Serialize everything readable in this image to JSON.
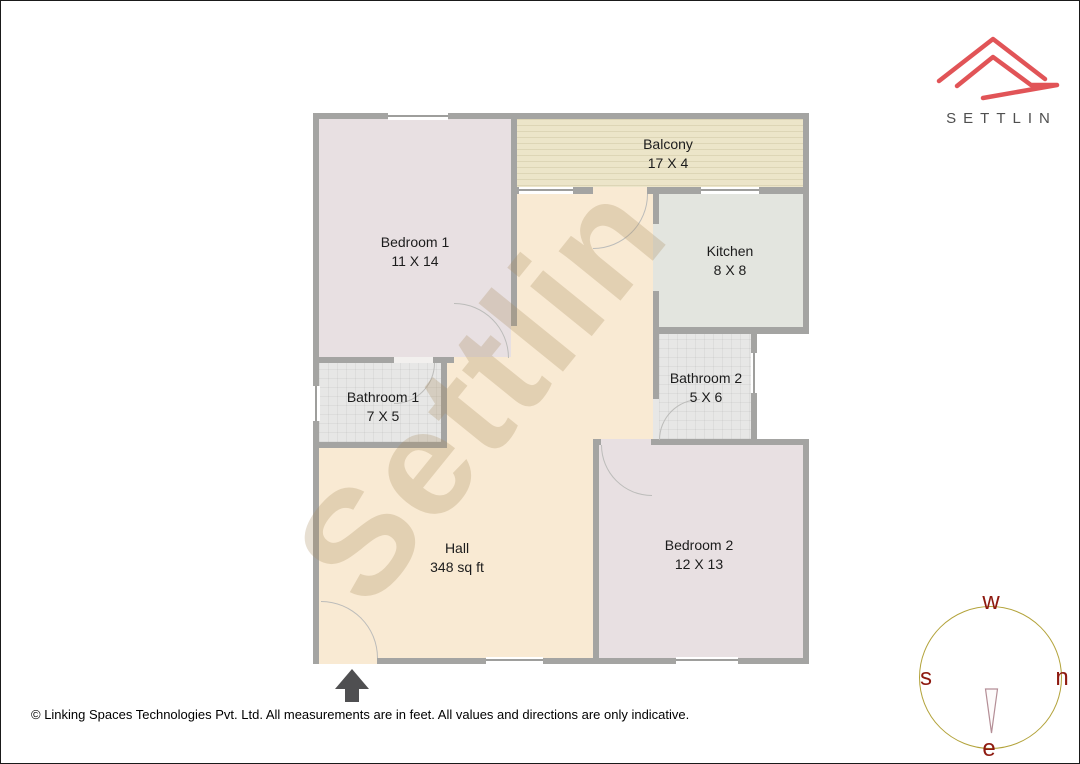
{
  "brand": {
    "name": "SETTLIN"
  },
  "plan": {
    "watermark": "Settlin",
    "rooms": {
      "bedroom1": {
        "label": "Bedroom 1",
        "dims": "11 X 14"
      },
      "balcony": {
        "label": "Balcony",
        "dims": "17 X 4"
      },
      "kitchen": {
        "label": "Kitchen",
        "dims": "8 X 8"
      },
      "bathroom1": {
        "label": "Bathroom 1",
        "dims": "7 X 5"
      },
      "bathroom2": {
        "label": "Bathroom 2",
        "dims": "5 X 6"
      },
      "bedroom2": {
        "label": "Bedroom 2",
        "dims": "12 X 13"
      },
      "hall": {
        "label": "Hall",
        "dims": "348 sq ft"
      }
    }
  },
  "compass": {
    "top": "w",
    "left": "s",
    "right": "n",
    "bottom": "e"
  },
  "footer": {
    "text": "© Linking Spaces Technologies Pvt. Ltd. All measurements are in feet. All values and directions are only indicative."
  },
  "colors": {
    "brand_red": "#e15457",
    "wall_gray": "#a4a4a2",
    "hall_fill": "#f9ead3",
    "bedroom_fill": "#e8e0e2",
    "balcony_fill": "#ece5c9",
    "kitchen_fill": "#e3e5df",
    "bathroom_fill": "#e7e7e6",
    "compass_circle": "#b3a33b",
    "compass_letters": "#8e1a10",
    "watermark_tint": "rgba(170,140,95,0.28)"
  }
}
